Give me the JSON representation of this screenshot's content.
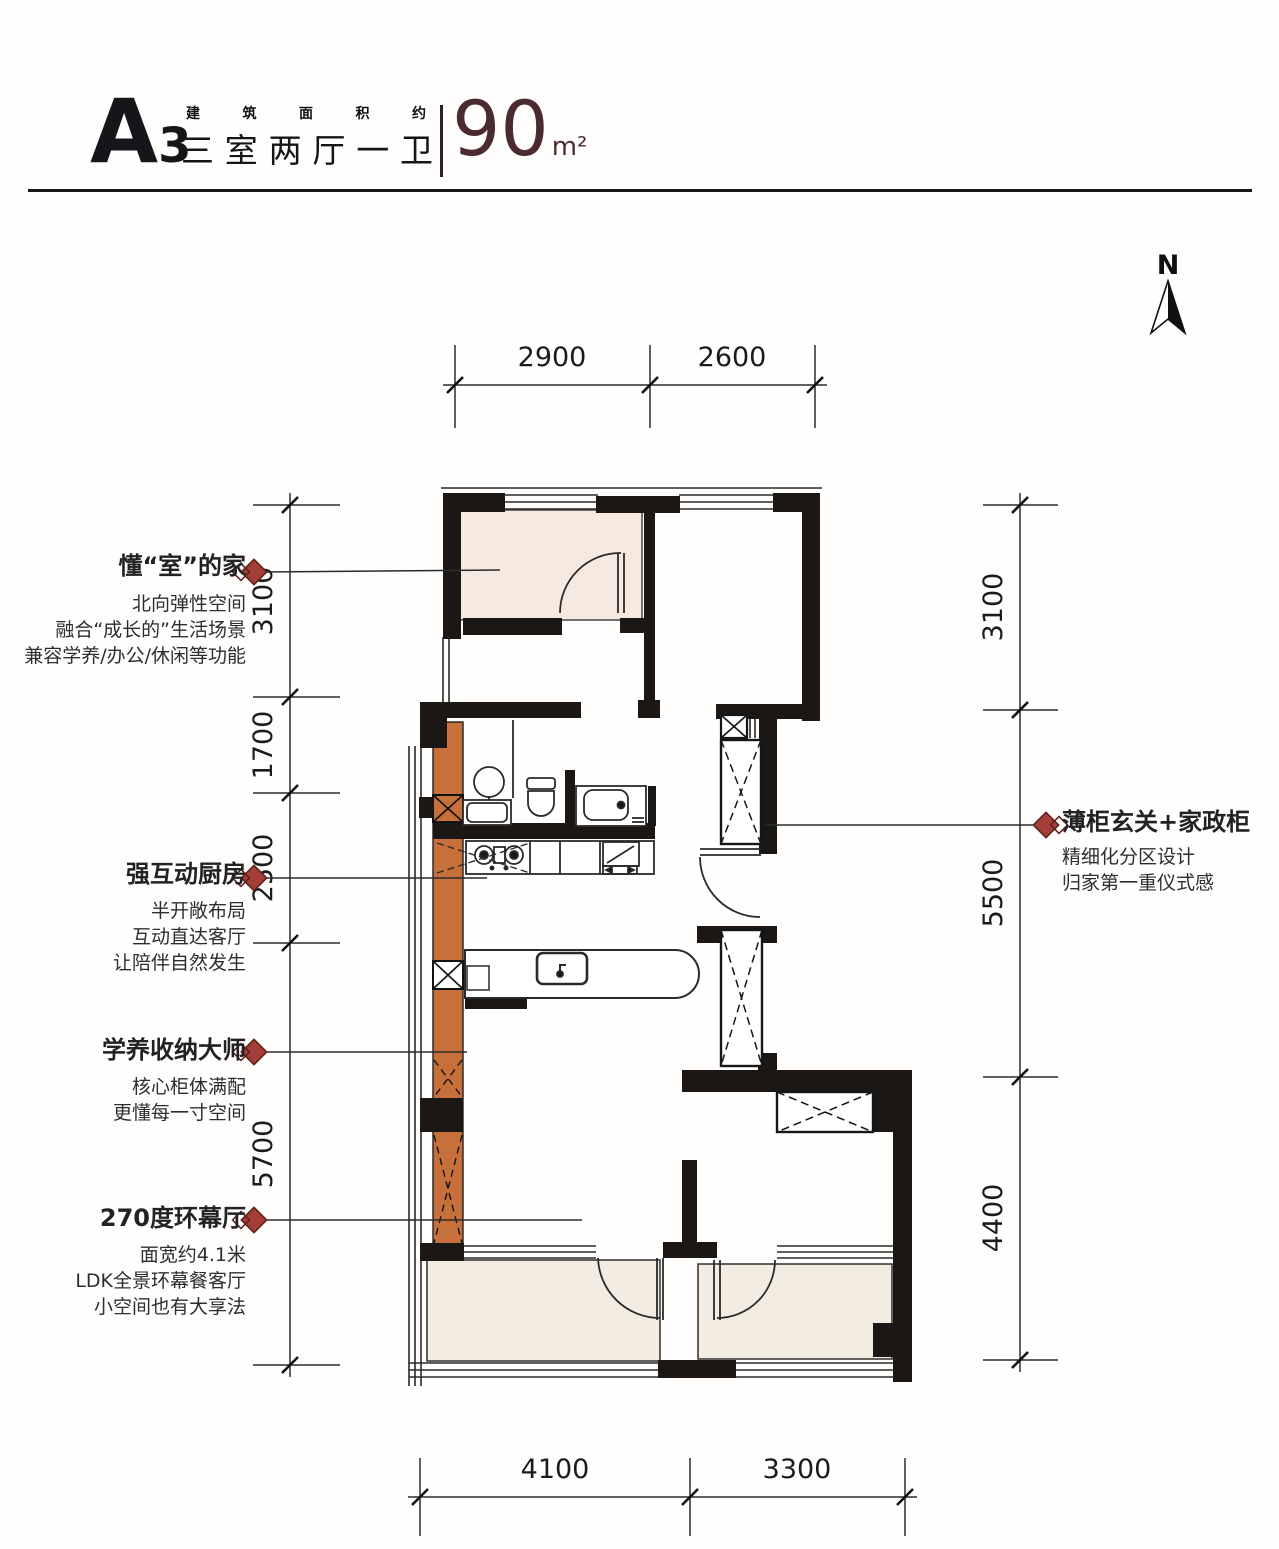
{
  "title": {
    "code_letter": "A",
    "code_number": "3",
    "small_label_chars": [
      "建",
      "筑",
      "面",
      "积",
      "约"
    ],
    "subtitle_chars": [
      "三",
      "室",
      "两",
      "厅",
      "一",
      "卫"
    ],
    "area_number": "90",
    "area_unit": "m²"
  },
  "north": {
    "label": "N"
  },
  "annotations": {
    "flex_room": {
      "title": "懂“室”的家",
      "line1": "北向弹性空间",
      "line2": "融合“成长的”生活场景",
      "line3": "兼容学养/办公/休闲等功能"
    },
    "kitchen": {
      "title": "强互动厨房",
      "line1": "半开敞布局",
      "line2": "互动直达客厅",
      "line3": "让陪伴自然发生"
    },
    "storage": {
      "title": "学养收纳大师",
      "line1": "核心柜体满配",
      "line2": "更懂每一寸空间"
    },
    "living": {
      "title": "270度环幕厅",
      "line1": "面宽约4.1米",
      "line2": "LDK全景环幕餐客厅",
      "line3": "小空间也有大享法"
    },
    "entry": {
      "title": "薄柜玄关+家政柜",
      "line1": "精细化分区设计",
      "line2": "归家第一重仪式感"
    }
  },
  "dimensions": {
    "top": [
      "2900",
      "2600"
    ],
    "bottom": [
      "4100",
      "3300"
    ],
    "left": [
      "3100",
      "1700",
      "2500",
      "5700"
    ],
    "right": [
      "3100",
      "5500",
      "4400"
    ]
  },
  "colors": {
    "accent_red": "#A43E38",
    "area_maroon": "#4B2A31",
    "cabinet_orange": "#C8703C",
    "room_beige": "#F6E9DF",
    "wall_black": "#1A1714"
  }
}
